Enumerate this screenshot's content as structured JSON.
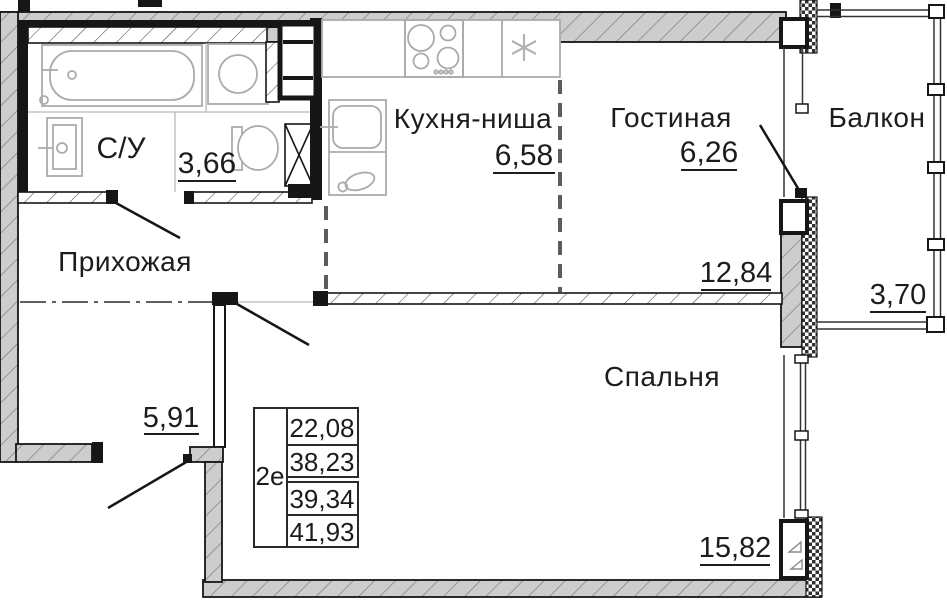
{
  "plan": {
    "rooms": [
      {
        "id": "bathroom",
        "label": "С/У",
        "area": "3,66"
      },
      {
        "id": "hallway",
        "label": "Прихожая",
        "area": "5,91"
      },
      {
        "id": "kitchen",
        "label": "Кухня-ниша",
        "area": "6,58"
      },
      {
        "id": "living",
        "label": "Гостиная",
        "area": "6,26"
      },
      {
        "id": "living_zone",
        "area": "12,84"
      },
      {
        "id": "bedroom",
        "label": "Спальня",
        "area": "15,82"
      },
      {
        "id": "balcony",
        "label": "Балкон",
        "area": "3,70"
      }
    ],
    "summary_table": {
      "type_label": "2е",
      "areas": [
        "22,08",
        "38,23",
        "39,34",
        "41,93"
      ]
    },
    "icons": {
      "bathtub": "bathtub-icon",
      "washing_machine": "washing-machine-icon",
      "wash_basin": "wash-basin-icon",
      "toilet": "toilet-icon",
      "vent_shaft": "vent-shaft-icon",
      "duct": "crossed-duct-icon",
      "stove": "stove-burners-icon",
      "fridge": "snowflake-icon",
      "kitchen_sink": "kitchen-sink-icon",
      "kettle": "kettle-icon"
    },
    "colors": {
      "wall_fill": "#cdcdcd",
      "hatch_line": "#787878",
      "outline": "#161616",
      "fixture_line": "#ababab",
      "dashed_line": "#5c5c5c",
      "text_color": "#1c1c1c"
    }
  }
}
